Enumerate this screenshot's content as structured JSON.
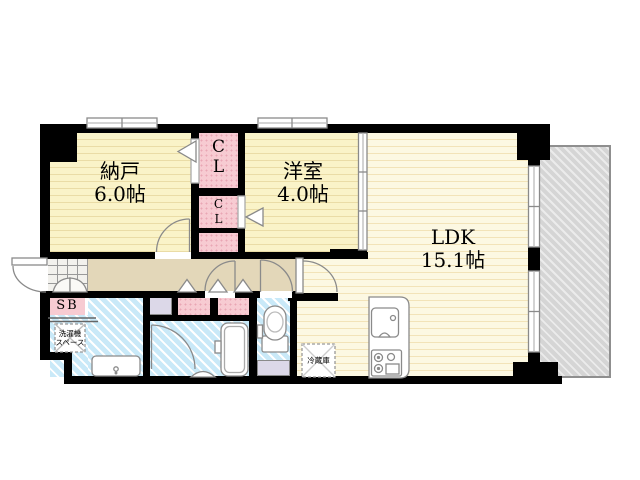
{
  "floorplan": {
    "type": "apartment-madori",
    "rooms": {
      "nando": {
        "name": "納戸",
        "size": "6.0帖"
      },
      "yoshitsu": {
        "name": "洋室",
        "size": "4.0帖"
      },
      "ldk": {
        "name": "LDK",
        "size": "15.1帖"
      },
      "cl1": {
        "c": "C",
        "l": "L"
      },
      "cl2": {
        "c": "C",
        "l": "L"
      },
      "sb": {
        "label": "SB"
      },
      "laundry": {
        "line1": "洗濯機",
        "line2": "スペース"
      },
      "fridge": {
        "label": "冷蔵庫"
      }
    },
    "colors": {
      "wall": "#000000",
      "room_yellow": "#FAF3C8",
      "ldk_yellow": "#FCF8E2",
      "hallway_tan": "#E3D7B9",
      "wet_area_blue": "#C9E9F8",
      "closet_pink": "#F7CBD2",
      "storage_lavender": "#DCD8E8",
      "balcony_gray": "#D5D5D5",
      "fixture_stroke": "#8A8A8A"
    }
  }
}
